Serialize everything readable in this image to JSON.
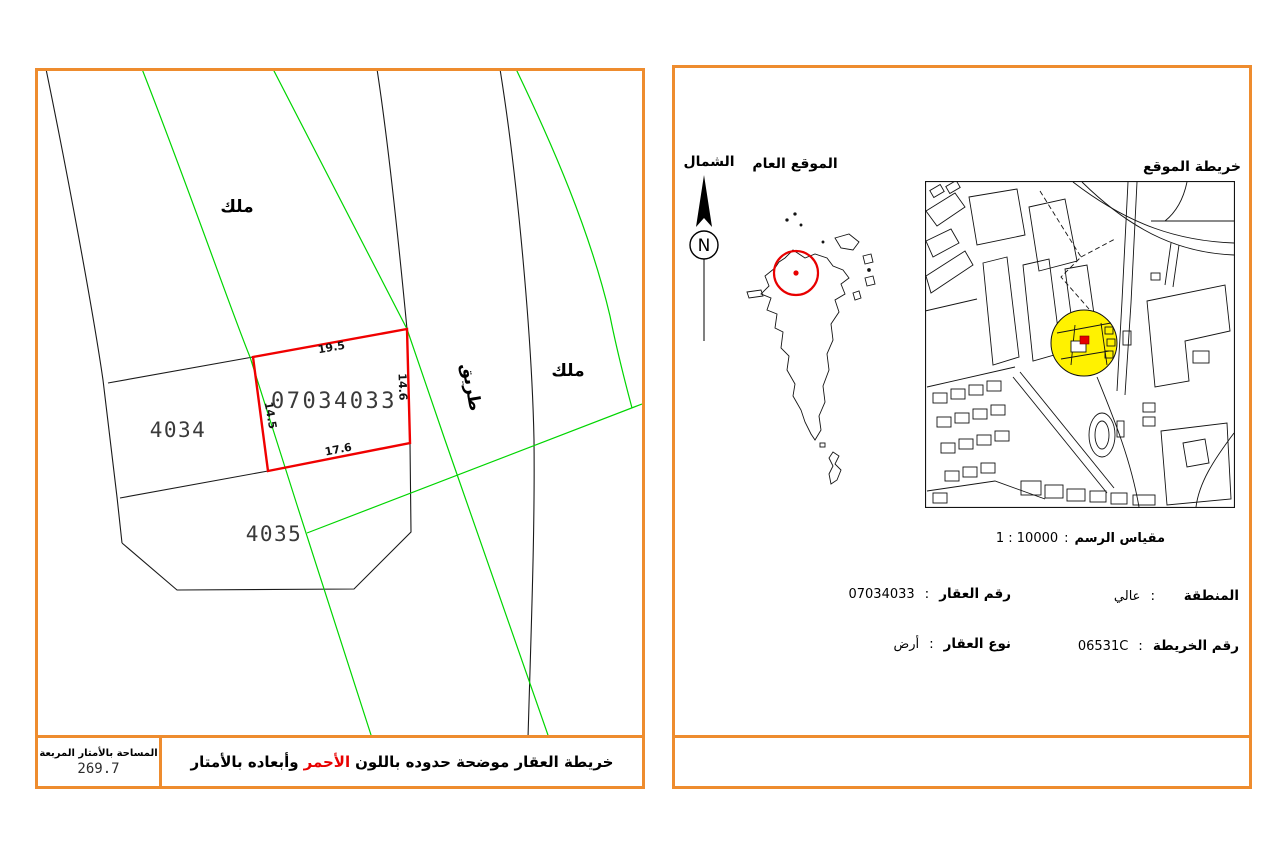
{
  "colors": {
    "frame_orange": "#EE8C2E",
    "parcel_red": "#F00000",
    "road_green": "#00D500",
    "highlight_yellow": "#FFF200"
  },
  "separator": ":",
  "left_panel": {
    "map": {
      "parcel_number": "07034033",
      "dims": {
        "top": "19.5",
        "right": "14.6",
        "left": "14.5",
        "bottom": "17.6"
      },
      "plot_4034": "4034",
      "plot_4035": "4035",
      "milk_top_left": "ملك",
      "milk_right": "ملك",
      "road": "طريق"
    },
    "area_box": {
      "label": "المساحة بالأمتار المربعة",
      "value": "269.7"
    },
    "caption": {
      "pre": "خريطة العقار موضحة حدوده باللون",
      "highlight": "الأحمر",
      "post": "وأبعاده بالأمتار"
    }
  },
  "right_panel": {
    "north_label": "الشمال",
    "compass_letter": "N",
    "general_location_label": "الموقع العام",
    "location_map_label": "خريطة الموقع",
    "scale": {
      "label": "مقياس الرسم",
      "value": "10000 : 1"
    },
    "info": {
      "region_label": "المنطقة",
      "region_value": "عالي",
      "map_number_label": "رقم الخريطة",
      "map_number_value": "06531C",
      "parcel_label": "رقم العقار",
      "parcel_value": "07034033",
      "type_label": "نوع العقار",
      "type_value": "أرض"
    }
  }
}
